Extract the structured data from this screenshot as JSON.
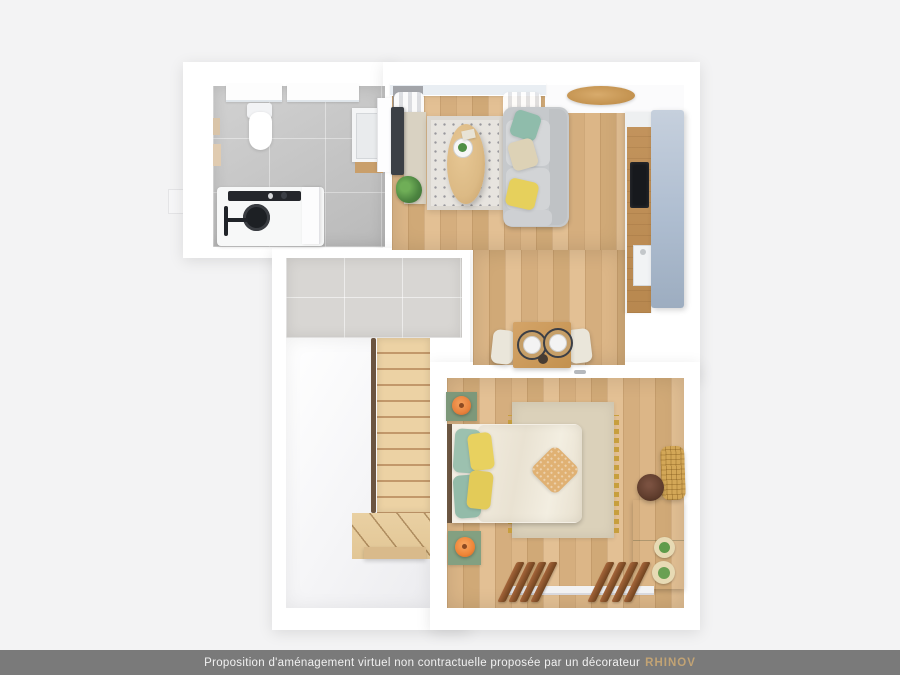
{
  "image": {
    "kind": "3d-floorplan-top-view-render",
    "width": 900,
    "height": 675
  },
  "footer": {
    "text": "Proposition d'aménagement virtuel non contractuelle proposée par un décorateur",
    "brand": "RHINOV",
    "bar_color": "#7a7a7a",
    "text_color": "#f1f1f1",
    "brand_color": "#c2a374"
  },
  "palette": {
    "background": "#f3f3f4",
    "walls": "#ffffff",
    "wood_floor": "#d8b285",
    "bathroom_tile": "#c6c6c6",
    "landing_tile": "#d8d6d3",
    "sofa_gray": "#cdd0d2",
    "pillow_teal": "#93bfae",
    "pillow_yellow": "#e7d15c",
    "pillow_cream": "#ddd2b6",
    "throw_tan": "#e0b173",
    "lamp_orange": "#ec8338",
    "furniture_green": "#84a081",
    "rattan": "#d3a757",
    "kitchen_tall_panel": "#aebdd0",
    "hob_black": "#17191d",
    "pouf_brown": "#5d3b2b"
  },
  "rooms": {
    "bathroom": {
      "items": [
        "toilet",
        "vanity-sink",
        "walk-in-shower",
        "shower-fixtures",
        "windows",
        "wall-art"
      ]
    },
    "living_room": {
      "items": [
        "sofa",
        "coffee-table",
        "patterned-rug",
        "tv",
        "tv-console",
        "plant",
        "window-curtains"
      ]
    },
    "kitchen": {
      "items": [
        "wood-counter",
        "induction-hob",
        "sink",
        "tall-cabinet",
        "round-entry-table"
      ]
    },
    "dining_area": {
      "items": [
        "square-table",
        "two-chairs",
        "two-place-settings"
      ]
    },
    "stair_hall": {
      "items": [
        "tiled-landing",
        "straight-stair-flight",
        "winder-steps",
        "handrail"
      ]
    },
    "bedroom": {
      "items": [
        "double-bed",
        "headboard",
        "nightstand-x2",
        "orange-lamp-x2",
        "green-dresser",
        "cactus-pots",
        "rattan-chair",
        "brown-pouf",
        "rug-with-fringe",
        "wood-slat-radiator-x2",
        "door-handle"
      ]
    }
  }
}
